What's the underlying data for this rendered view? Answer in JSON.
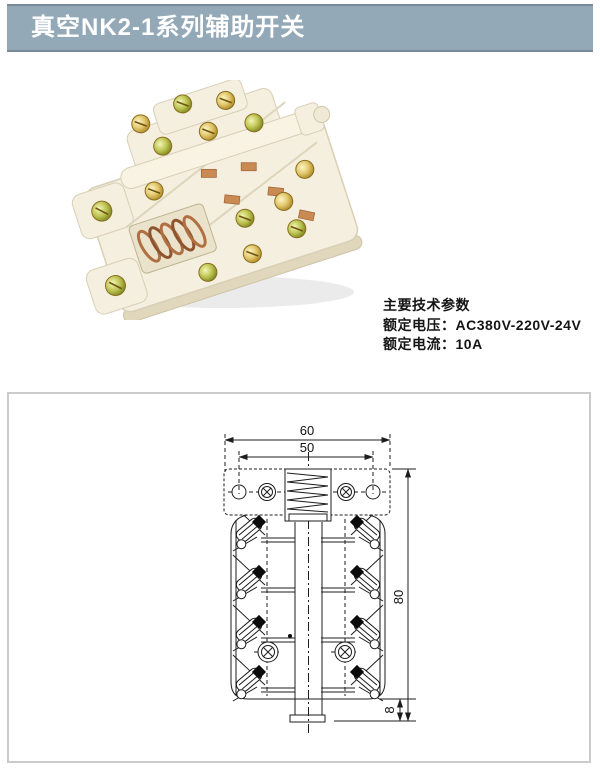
{
  "page": {
    "background": "#ffffff"
  },
  "header": {
    "title": "真空NK2-1系列辅助开关",
    "background": "#94a9b8",
    "text_color": "#ffffff"
  },
  "photo": {
    "description": "NK2-1 auxiliary switch product photo",
    "body_color": "#f4efdf",
    "screw_color": "#c9a227",
    "spring_color": "#b06f42"
  },
  "specs": {
    "heading": "主要技术参数",
    "rows": [
      {
        "label": "额定电压：",
        "value": "AC380V-220V-24V"
      },
      {
        "label": "额定电流：",
        "value": "10A"
      }
    ]
  },
  "drawing": {
    "dims": {
      "outer_width": "60",
      "hole_spacing": "50",
      "body_height": "80",
      "shaft_length": "8"
    },
    "line_color": "#1d1d1d",
    "border_color": "#cbcbcb"
  }
}
